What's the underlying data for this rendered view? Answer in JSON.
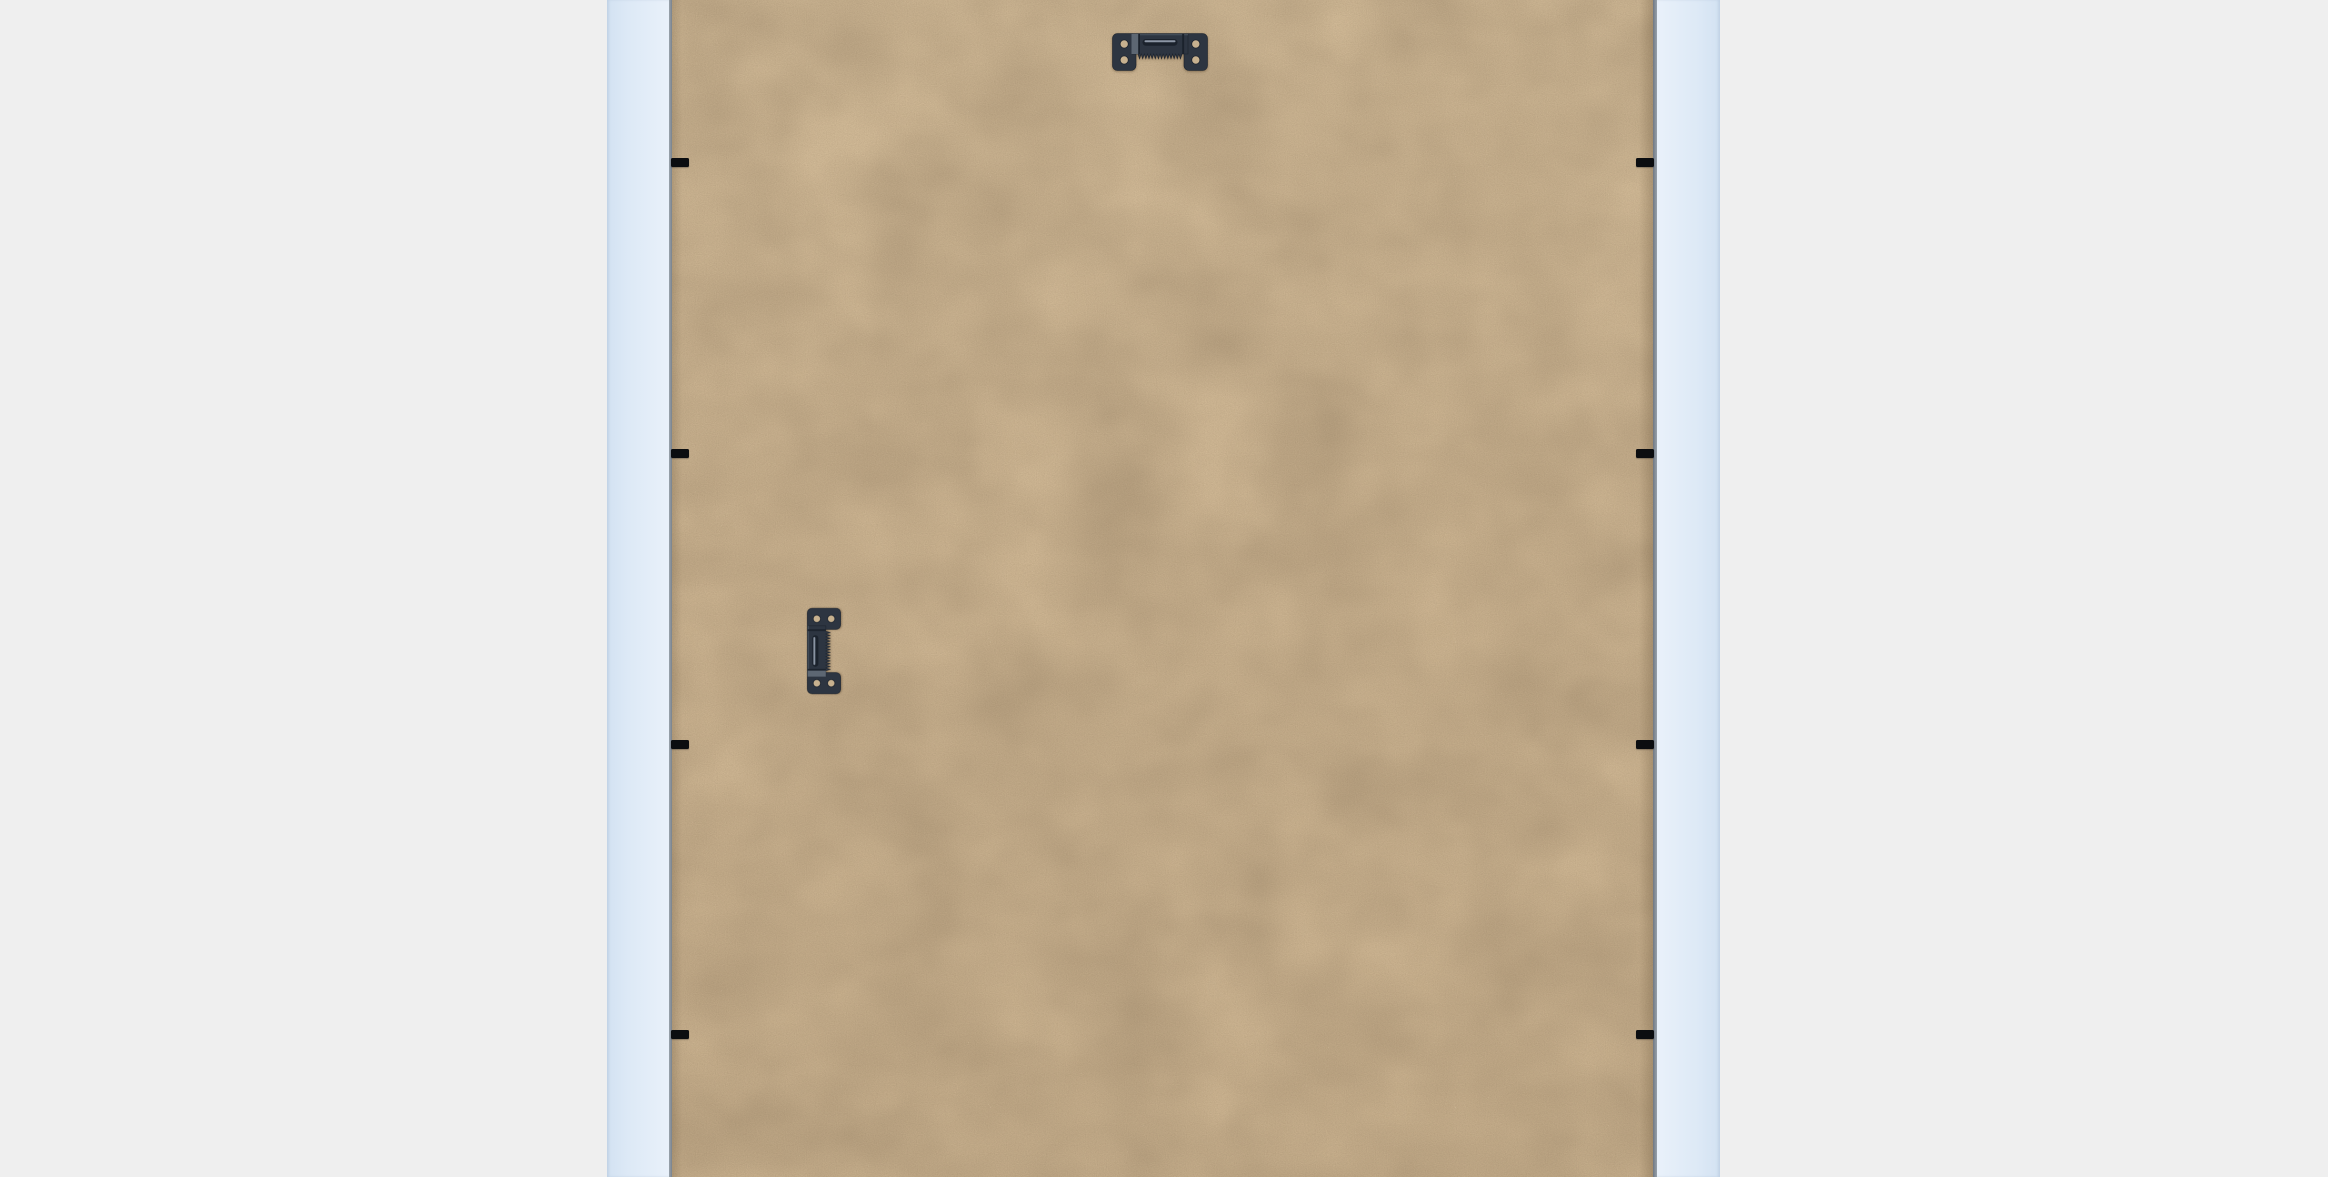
{
  "scene": {
    "name": "picture-frame-back",
    "description": "Rear view of a picture frame: pale-blue frame rails at left and right, a kraft MDF backing board held in by black flexible points, one horizontal sawtooth hanger at top centre and one vertical sawtooth hanger on the left side.",
    "background_color": "#efefef"
  },
  "colors": {
    "background": "#efefef",
    "rail": "#dde9f6",
    "rail_outer": "#d3e2f2",
    "rail_inner": "#e9f1fa",
    "board": "#cfb794",
    "edge_line": "#828b95",
    "tab": "#0b0d10",
    "hardware": "#2d3541",
    "hardware_dark": "#1b222c",
    "hardware_band": "#5d6773",
    "hardware_highlight": "#8c96a5",
    "hole": "#c7b18f"
  },
  "frame": {
    "rails": [
      {
        "side": "left",
        "x": 607,
        "width": 62
      },
      {
        "side": "right",
        "x": 1657,
        "width": 63
      }
    ],
    "edge_lines": [
      {
        "side": "left",
        "x": 669,
        "width": 3
      },
      {
        "side": "right",
        "x": 1653,
        "width": 4
      }
    ],
    "board": {
      "x": 672,
      "width": 981
    }
  },
  "hardware": {
    "hangers": [
      {
        "name": "sawtooth-hanger-top",
        "cx": 1160,
        "cy": 52,
        "rotation": 0,
        "scale": 1
      },
      {
        "name": "sawtooth-hanger-side",
        "cx": 824,
        "cy": 651,
        "rotation": -90,
        "scale": 0.9
      }
    ],
    "flex_tabs": {
      "size": {
        "w": 18,
        "h": 9
      },
      "left": {
        "x": 671,
        "y_centers": [
          162,
          453,
          744,
          1034
        ]
      },
      "right": {
        "x": 1636,
        "y_centers": [
          162,
          453,
          744,
          1034
        ]
      }
    }
  }
}
